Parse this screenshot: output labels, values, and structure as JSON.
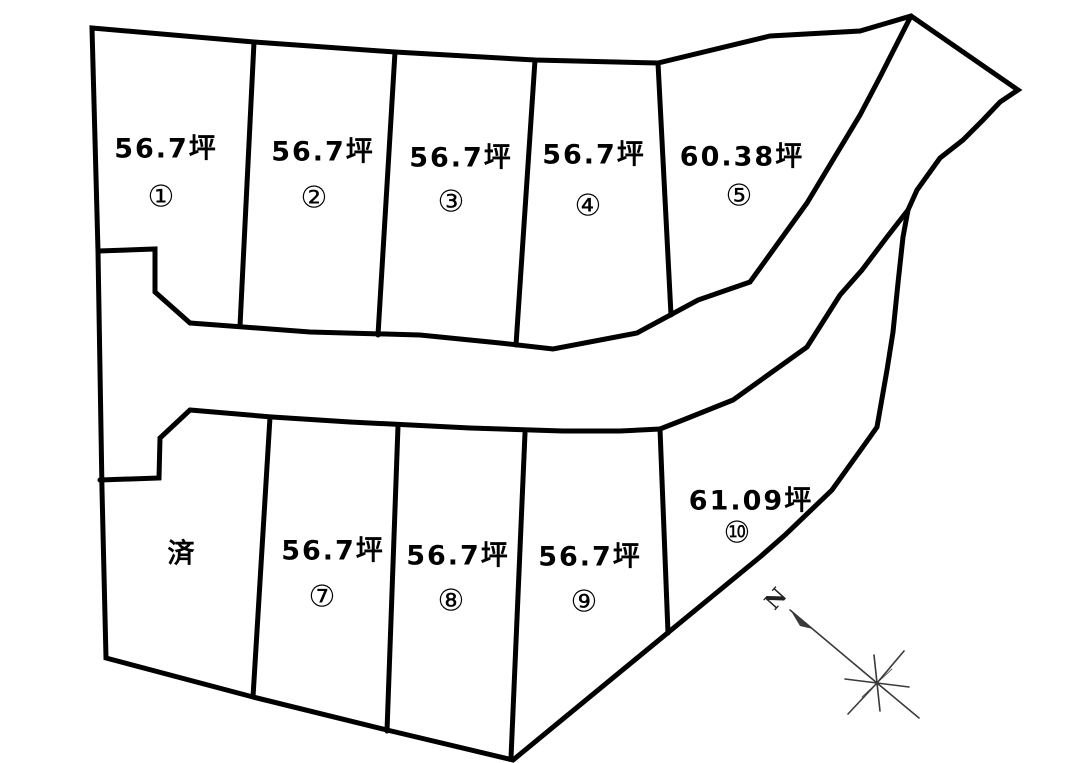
{
  "plots": [
    {
      "area": "56.7坪",
      "num": "①"
    },
    {
      "area": "56.7坪",
      "num": "②"
    },
    {
      "area": "56.7坪",
      "num": "③"
    },
    {
      "area": "56.7坪",
      "num": "④"
    },
    {
      "area": "60.38坪",
      "num": "⑤"
    },
    {
      "area": "済",
      "num": ""
    },
    {
      "area": "56.7坪",
      "num": "⑦"
    },
    {
      "area": "56.7坪",
      "num": "⑧"
    },
    {
      "area": "56.7坪",
      "num": "⑨"
    },
    {
      "area": "61.09坪",
      "num": "⑩"
    }
  ],
  "compass": {
    "north": "N"
  },
  "colors": {
    "line": "#000000",
    "background": "#ffffff",
    "compass": "#3a3a3a"
  }
}
